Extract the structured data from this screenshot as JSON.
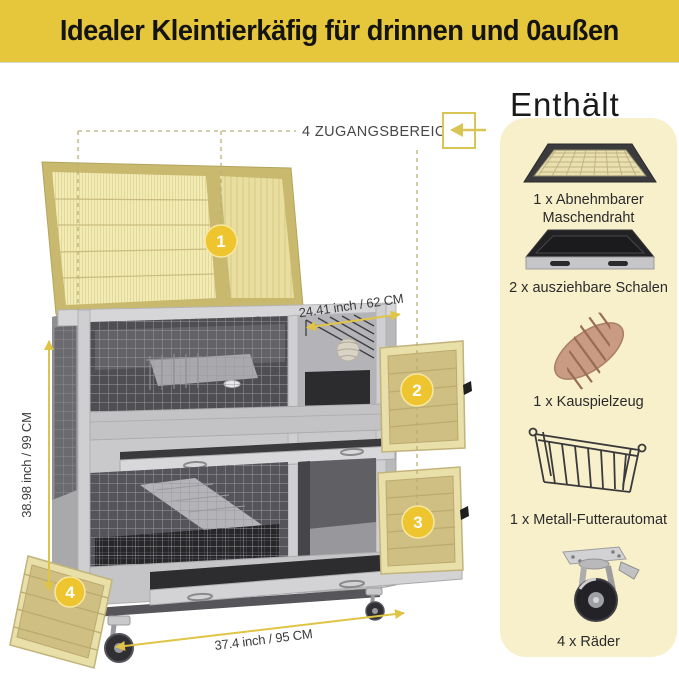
{
  "banner": {
    "title": "Idealer Kleintierkäfig für drinnen und 0außen"
  },
  "includes": {
    "heading": "Enthält",
    "items": [
      {
        "icon": "mesh-tray-icon",
        "label": "1 x Abnehmbarer Maschendraht"
      },
      {
        "icon": "slide-out-tray-icon",
        "label": "2 x ausziehbare Schalen"
      },
      {
        "icon": "chew-toy-icon",
        "label": "1 x Kauspielzeug"
      },
      {
        "icon": "metal-feeder-icon",
        "label": "1 x Metall-Futterautomat"
      },
      {
        "icon": "caster-wheel-icon",
        "label": "4 x Räder"
      }
    ]
  },
  "annotations": {
    "access_areas": "4 ZUGANGSBEREICHE",
    "markers": [
      "1",
      "2",
      "3",
      "4"
    ],
    "dim_top": "24.41 inch / 62 CM",
    "dim_left": "38.98 inch / 99 CM",
    "dim_bottom": "37.4 inch / 95 CM"
  },
  "colors": {
    "banner_yellow": "#E6C63A",
    "accent_yellow": "#EFC52F",
    "panel_cream": "#F8F0CA",
    "arrow_yellow": "#DFC445",
    "wood_tan": "#D0BF82",
    "cage_gray": "#C9C9CB"
  }
}
